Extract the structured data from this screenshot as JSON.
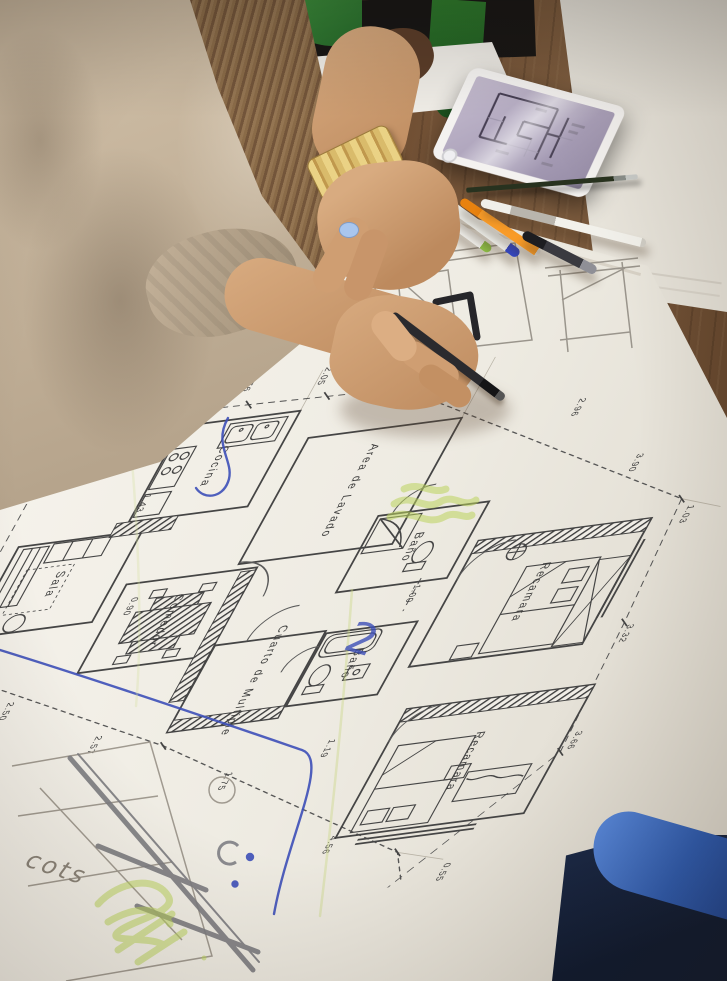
{
  "scene": {
    "description": "Overhead photo of a student drawing over a printed architectural floor plan on a wooden studio desk, with a tablet showing the same plan, pens and a second person's hand at the top edge",
    "people": {
      "main": "person in beige jacket drawing with a black pen",
      "second": "second person's hand over papers at top edge"
    }
  },
  "floor_plan": {
    "rooms": [
      {
        "label": "Cocina"
      },
      {
        "label": "Area de Lavado"
      },
      {
        "label": "Baño"
      },
      {
        "label": "Recamara"
      },
      {
        "label": "Sala"
      },
      {
        "label": "Comedor"
      },
      {
        "label": "Cuarto de Multiple"
      },
      {
        "label": "Baño"
      },
      {
        "label": "Recamara"
      },
      {
        "label": "Entrada"
      }
    ],
    "dims": [
      "2.76",
      "2.05",
      "2.65",
      "5.60",
      "2.96",
      "3.90",
      "1.03",
      "3.32",
      "3.66",
      "0.55",
      "2.50",
      "2.57",
      "1.75",
      "4.56",
      "1.19",
      "1.43",
      "0.90",
      "1.00",
      "1.00"
    ],
    "annotations": {
      "handwritten_note": "cots",
      "handwritten_mark": "2"
    }
  },
  "objects": {
    "tablet": "tablet-floor-plan-app",
    "pencil": "graphite-pencil",
    "pens": [
      "white-pen-green-cap",
      "white-pen-blue-cap",
      "orange-pen",
      "white-pen-gray-grip",
      "black-pen"
    ],
    "marker": "black-marker",
    "watch": "gold-watch",
    "chair": "blue-chair",
    "nail_polish": "light-blue"
  },
  "colors": {
    "desk_wood": "#6e4c30",
    "paper": "#f1eee7",
    "jacket": "#b7a68d",
    "plan_ink": "#3f3f3f",
    "highlighter_green": "#bcd45e",
    "ballpoint_blue": "#3d4fb8",
    "pen_green_cap": "#7ab834",
    "pen_blue_cap": "#2a3fc0",
    "pen_orange": "#f79420",
    "tablet_screen": "#b4aac0",
    "chair_blue": "#2f5cb0"
  }
}
